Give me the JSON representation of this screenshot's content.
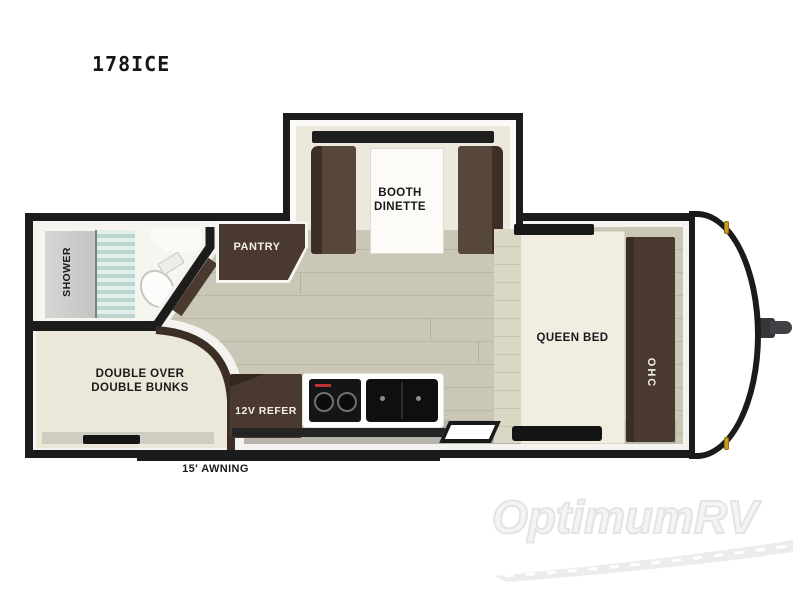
{
  "title": "178ICE",
  "floorplan": {
    "slideout": {
      "label": "BOOTH\nDINETTE"
    },
    "bathroom": {
      "shower_label": "SHOWER"
    },
    "pantry": {
      "label": "PANTRY"
    },
    "bunk_room": {
      "label": "DOUBLE OVER\nDOUBLE BUNKS"
    },
    "kitchen": {
      "refrigerator_label": "12V REFER"
    },
    "bedroom": {
      "bed_label": "QUEEN BED",
      "cabinet_label": "OHC"
    },
    "awning": {
      "label": "15' AWNING"
    }
  },
  "watermark": {
    "text": "OptimumRV"
  },
  "colors": {
    "wall": "#1c1c1c",
    "furniture_brown": "#4a392e",
    "floor_plank": "#c9c6b5",
    "interior_cream": "#ece9dc",
    "shower_glass": "#cfe3dd",
    "marker_light": "#c8991d",
    "stove_brand_mark": "#bb3333",
    "watermark_gray": "#ececec"
  }
}
